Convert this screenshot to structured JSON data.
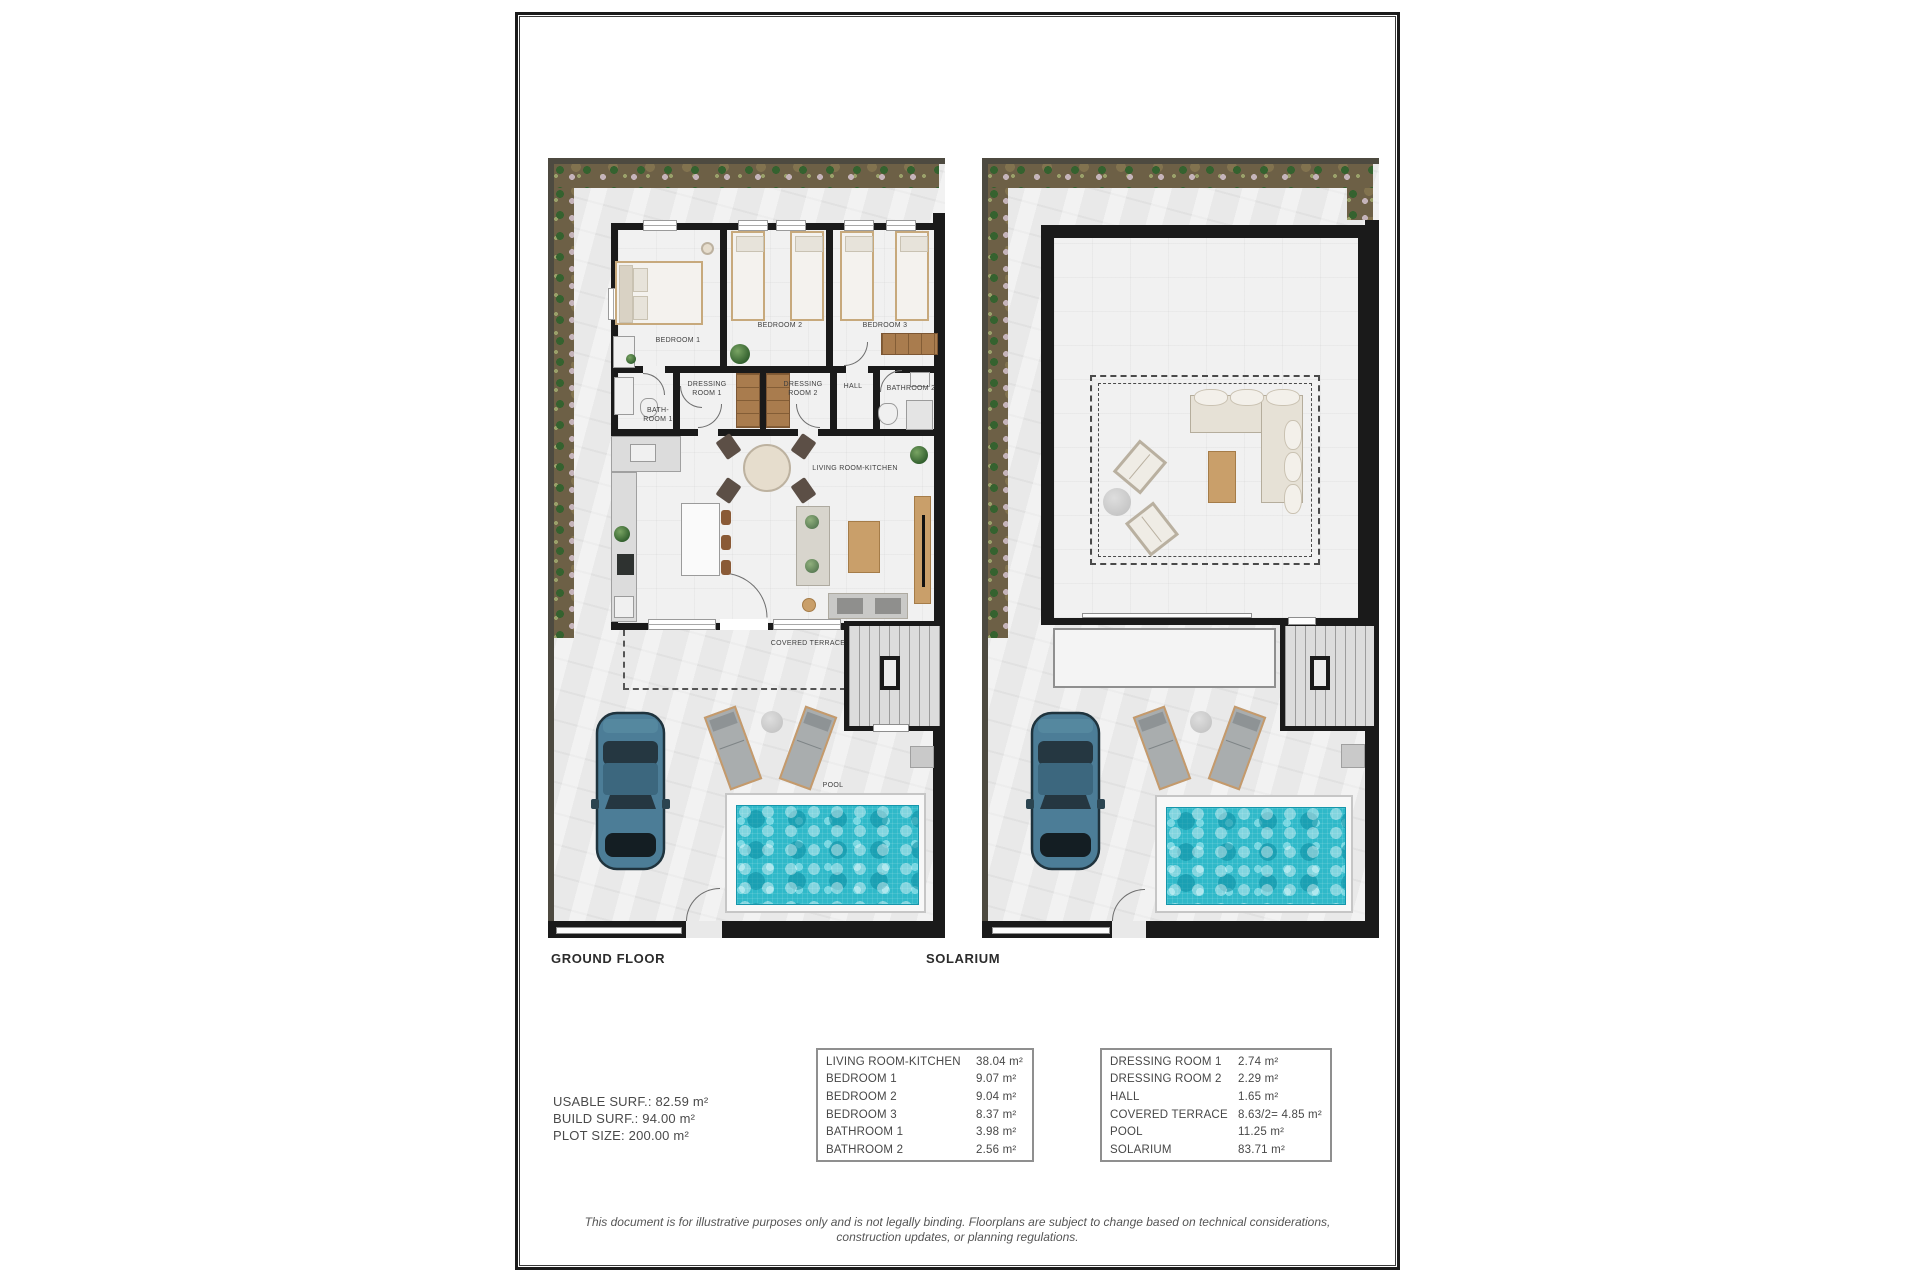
{
  "titles": {
    "ground": "GROUND FLOOR",
    "solarium": "SOLARIUM"
  },
  "summary": {
    "usable": "USABLE SURF.: 82.59 m²",
    "build": "BUILD SURF.: 94.00 m²",
    "plot": "PLOT SIZE: 200.00 m²"
  },
  "tables": {
    "left": {
      "rows": [
        {
          "name": "LIVING ROOM-KITCHEN",
          "area": "38.04 m²"
        },
        {
          "name": "BEDROOM 1",
          "area": "9.07 m²"
        },
        {
          "name": "BEDROOM 2",
          "area": "9.04 m²"
        },
        {
          "name": "BEDROOM 3",
          "area": "8.37 m²"
        },
        {
          "name": "BATHROOM 1",
          "area": "3.98 m²"
        },
        {
          "name": "BATHROOM 2",
          "area": "2.56 m²"
        }
      ]
    },
    "right": {
      "rows": [
        {
          "name": "DRESSING ROOM 1",
          "area": "2.74 m²"
        },
        {
          "name": "DRESSING ROOM 2",
          "area": "2.29 m²"
        },
        {
          "name": "HALL",
          "area": "1.65 m²"
        },
        {
          "name": "COVERED TERRACE",
          "area": "8.63/2= 4.85 m²"
        },
        {
          "name": "POOL",
          "area": "11.25 m²"
        },
        {
          "name": "SOLARIUM",
          "area": "83.71 m²"
        }
      ]
    }
  },
  "rooms": {
    "bedroom1": "BEDROOM 1",
    "bedroom2": "BEDROOM 2",
    "bedroom3": "BEDROOM 3",
    "dressing1": "DRESSING ROOM 1",
    "dressing2": "DRESSING ROOM 2",
    "hall": "HALL",
    "bathroom1": "BATH-ROOM 1",
    "bathroom2": "BATHROOM 2",
    "living": "LIVING ROOM-KITCHEN",
    "terrace": "COVERED TERRACE",
    "pool": "POOL"
  },
  "disclaimer": "This document is for illustrative purposes only and is not legally binding. Floorplans are subject to change based on technical considerations, construction updates, or planning regulations."
}
